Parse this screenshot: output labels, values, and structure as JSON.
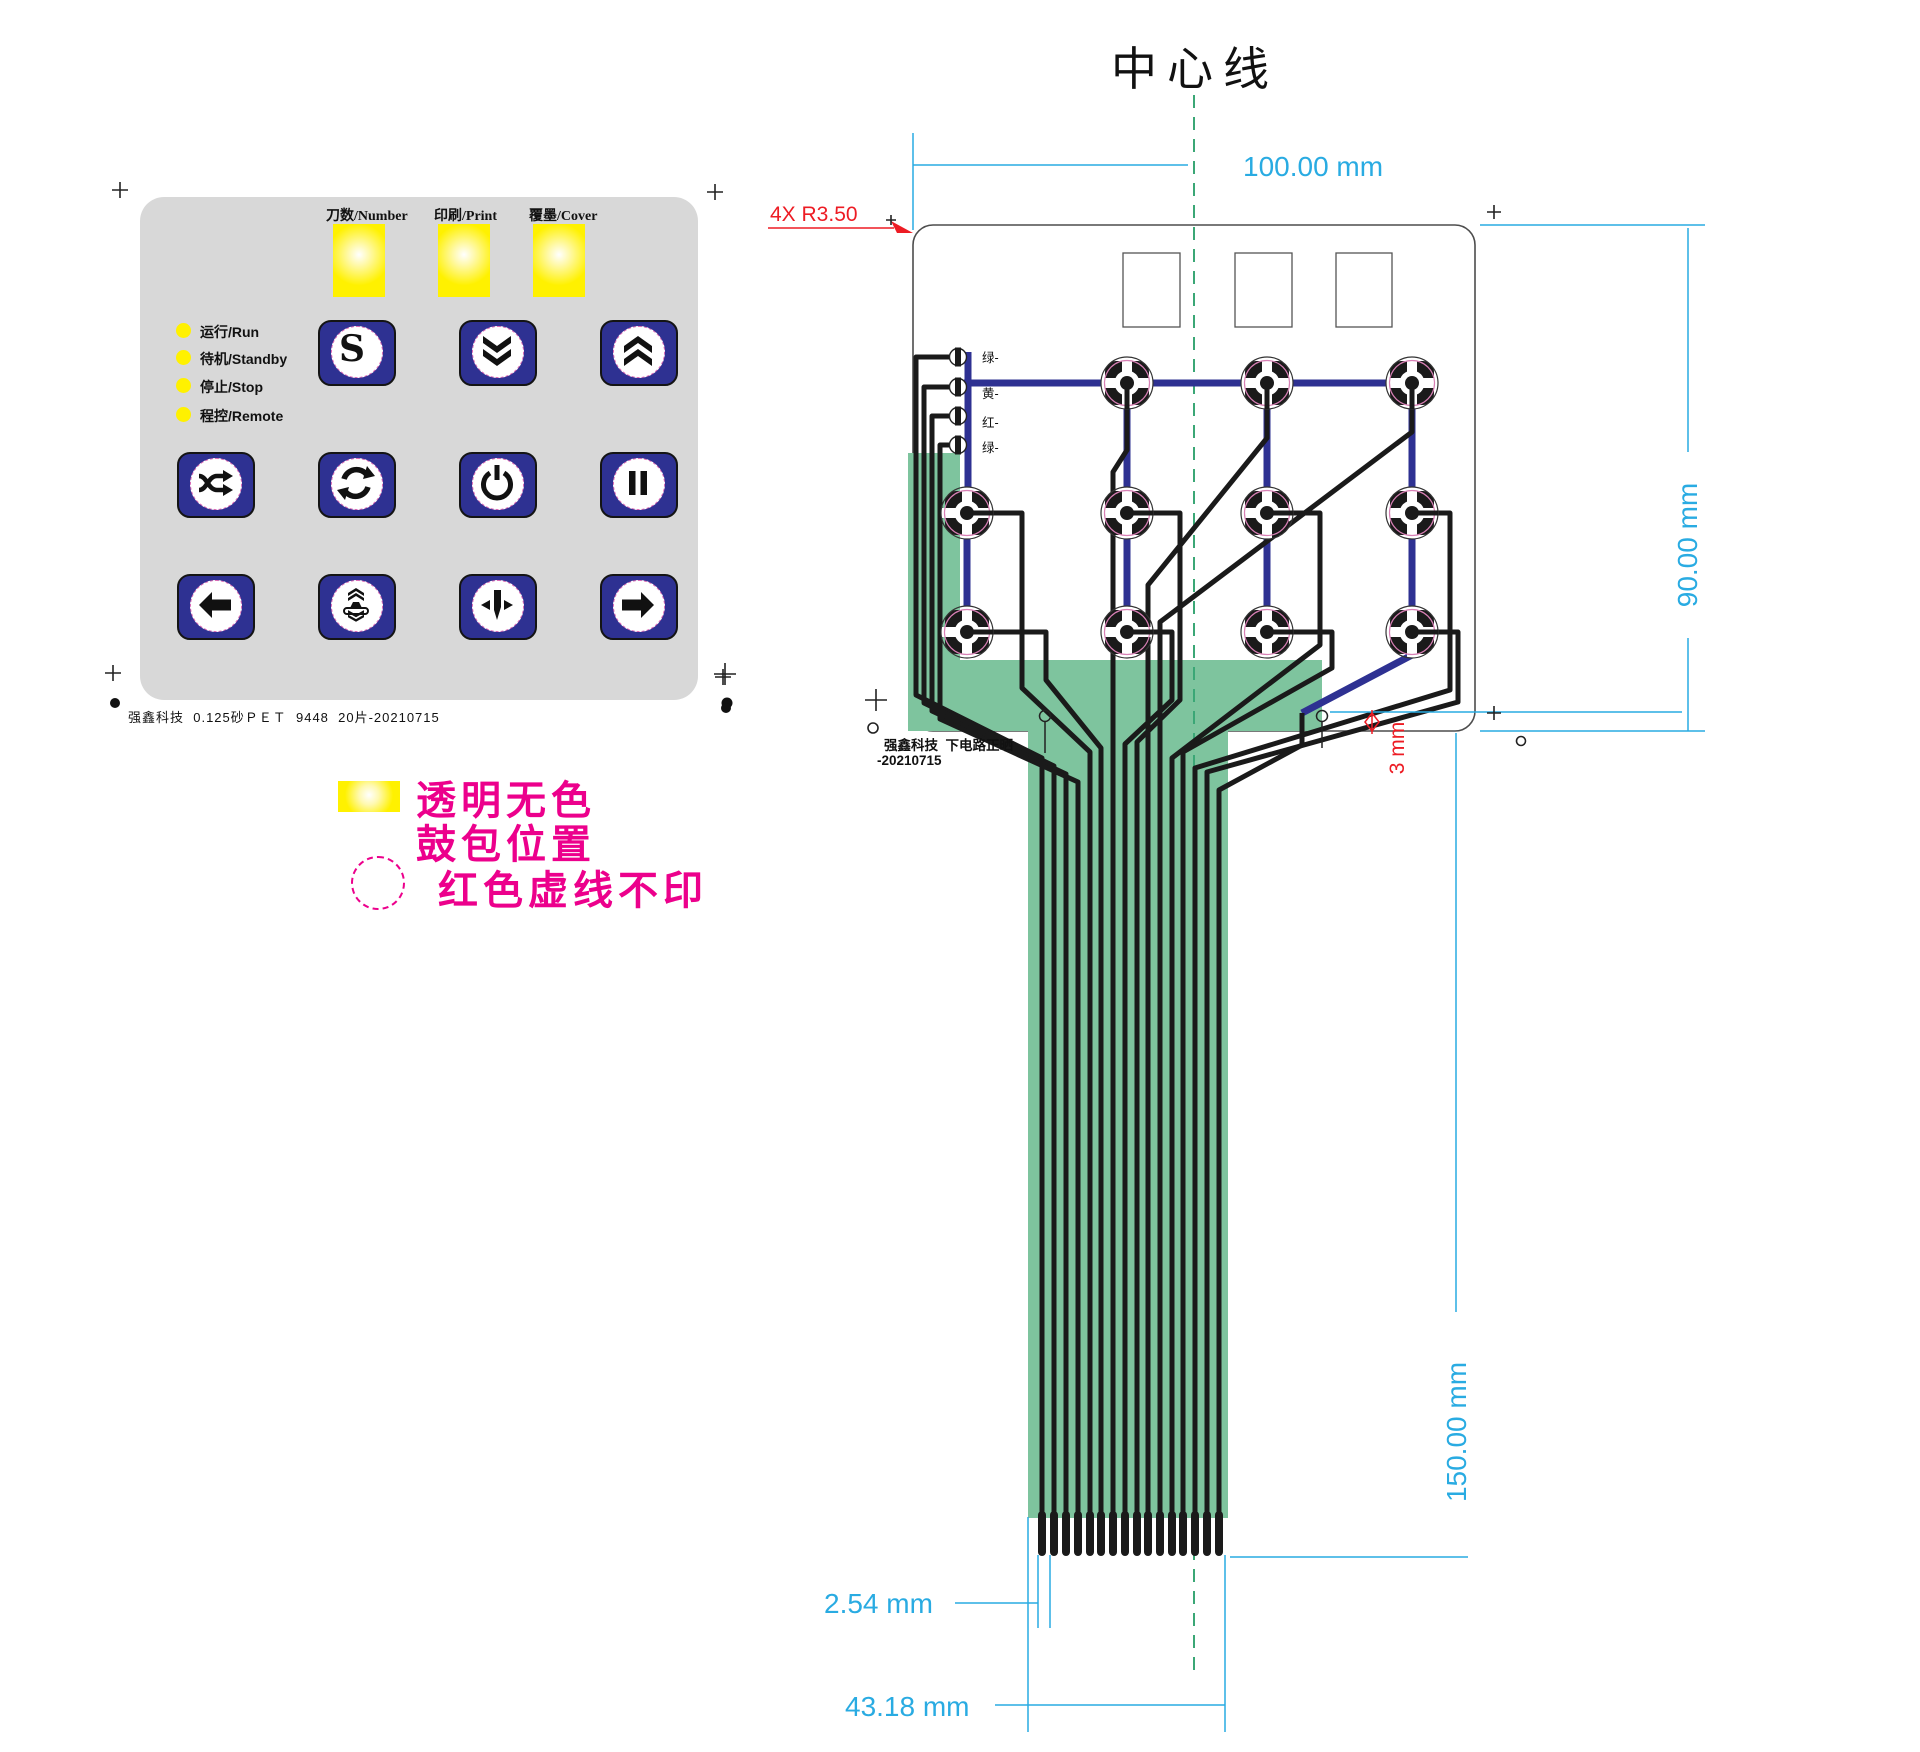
{
  "keypad": {
    "window_labels": [
      "刀数/Number",
      "印刷/Print",
      "覆墨/Cover"
    ],
    "leds": [
      {
        "label": "运行/Run"
      },
      {
        "label": "待机/Standby"
      },
      {
        "label": "停止/Stop"
      },
      {
        "label": "程控/Remote"
      }
    ],
    "buttons": [
      {
        "icon": "s-key"
      },
      {
        "icon": "double-chevron-down"
      },
      {
        "icon": "double-chevron-up"
      },
      {
        "icon": "shuffle"
      },
      {
        "icon": "cycle"
      },
      {
        "icon": "power"
      },
      {
        "icon": "pause"
      },
      {
        "icon": "arrow-left"
      },
      {
        "icon": "stamp-press"
      },
      {
        "icon": "align-center-down"
      },
      {
        "icon": "arrow-right"
      }
    ],
    "s_button_glyph": "S",
    "footer_note": "强鑫科技  0.125砂ＰＥＴ  9448  20片-20210715"
  },
  "legend": {
    "swatch_line1": "透明无色",
    "swatch_line2": "鼓包位置",
    "dashed_line": "红色虚线不印"
  },
  "drawing": {
    "title": "中心线",
    "corner_callout": "4X R3.50",
    "led_labels": [
      "绿-",
      "黄-",
      "红-",
      "绿-"
    ],
    "stamp_note": "强鑫科技  下电路正晒",
    "stamp_date": "-20210715",
    "dim_width": "100.00 mm",
    "dim_height": "90.00 mm",
    "dim_tail_length": "150.00 mm",
    "dim_pitch": "2.54 mm",
    "dim_tail_width": "43.18 mm",
    "dim_hole": "3 mm"
  },
  "colors": {
    "panel_gray": "#D8D8D8",
    "button_navy": "#2E3192",
    "window_yellow": "#FFF100",
    "legend_magenta": "#EC008C",
    "dimension_blue": "#29ABE2",
    "callout_red": "#ED1C24",
    "tail_green": "#7EC49E",
    "centerline_green": "#3BA776",
    "trace_blue": "#2E3192",
    "trace_black": "#1A1A1A"
  }
}
